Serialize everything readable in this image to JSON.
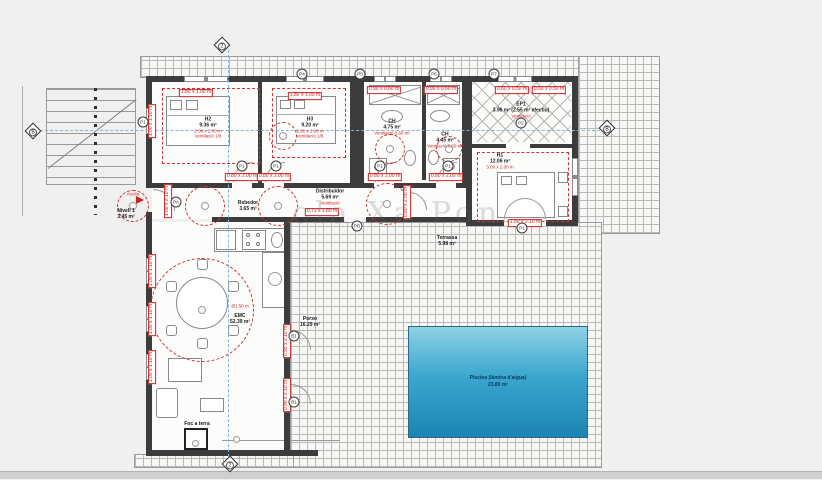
{
  "watermark": "ola Xa Pon",
  "pool": {
    "name": "Piscina (làmina d'aigua)",
    "area": "23.80 m²"
  },
  "labels": [
    {
      "id": "h2",
      "x": 208,
      "y": 128,
      "lines": [
        "H2",
        "9.36 m²"
      ],
      "red": [
        "2.00 x 2.00 m",
        "Ventilació 1/8"
      ]
    },
    {
      "id": "h3",
      "x": 310,
      "y": 128,
      "lines": [
        "H3",
        "9.20 m²"
      ],
      "red": [
        "2.00 x 2.00 m",
        "Ventilació 1/8"
      ]
    },
    {
      "id": "ch1",
      "x": 392,
      "y": 127,
      "lines": [
        "CH",
        "4.75 m²"
      ],
      "red": [
        "Ventilació 0.60 m²"
      ]
    },
    {
      "id": "ch2",
      "x": 445,
      "y": 140,
      "lines": [
        "CH",
        "4.45 m²"
      ],
      "red": [
        "Ventilació 0.60 m²"
      ]
    },
    {
      "id": "ep1",
      "x": 521,
      "y": 110,
      "lines": [
        "EP1",
        "3.96 m² (2.55 m² efectiu)"
      ],
      "red": [
        "Ventilació"
      ]
    },
    {
      "id": "h1",
      "x": 500,
      "y": 161,
      "lines": [
        "H1",
        "12.06 m²"
      ],
      "red": [
        "3.00 x 2.00 m"
      ]
    },
    {
      "id": "distribuidor",
      "x": 330,
      "y": 197,
      "lines": [
        "Distribuïdor",
        "5.69 m²"
      ],
      "red": [
        "Ventilació"
      ]
    },
    {
      "id": "rebedor",
      "x": 248,
      "y": 206,
      "lines": [
        "Rebedor",
        "3.65 m²"
      ],
      "red": []
    },
    {
      "id": "terrassa",
      "x": 447,
      "y": 241,
      "lines": [
        "Terrassa",
        "5.98 m²"
      ],
      "red": []
    },
    {
      "id": "emc-circle",
      "x": 240,
      "y": 306,
      "lines": [],
      "red": [
        "Ø1.50 m"
      ]
    },
    {
      "id": "emc",
      "x": 240,
      "y": 319,
      "lines": [
        "EMC",
        "52.39 m²"
      ],
      "red": []
    },
    {
      "id": "porxo",
      "x": 310,
      "y": 322,
      "lines": [
        "Porxo",
        "16.29 m²"
      ],
      "red": []
    },
    {
      "id": "nivell",
      "x": 126,
      "y": 214,
      "lines": [
        "Nivell 1",
        "3.45 m²"
      ],
      "red": []
    },
    {
      "id": "acces",
      "x": 133,
      "y": 194,
      "lines": [],
      "red": [
        "Accés"
      ]
    },
    {
      "id": "foc-a-terra",
      "x": 197,
      "y": 424,
      "lines": [
        "Foc a terra"
      ],
      "red": []
    }
  ],
  "dims": [
    {
      "t": "1.80 x 1.00 m",
      "x": 196,
      "y": 93,
      "v": 0
    },
    {
      "t": "1.00 x 1.10 m",
      "x": 152,
      "y": 121,
      "v": 1
    },
    {
      "t": "1.80 x 1.00 m",
      "x": 305,
      "y": 96,
      "v": 0
    },
    {
      "t": "0.90 x 0.60 m",
      "x": 384,
      "y": 90,
      "v": 0
    },
    {
      "t": "0.90 x 0.60 m",
      "x": 441,
      "y": 90,
      "v": 0
    },
    {
      "t": "0.60 x 0.50 m",
      "x": 512,
      "y": 90,
      "v": 0
    },
    {
      "t": "0.60 x 0.50 m",
      "x": 549,
      "y": 90,
      "v": 0
    },
    {
      "t": "0.80 x 2.00 m",
      "x": 242,
      "y": 177,
      "v": 0
    },
    {
      "t": "0.80 x 2.00 m",
      "x": 274,
      "y": 177,
      "v": 0
    },
    {
      "t": "0.80 x 2.00 m",
      "x": 385,
      "y": 177,
      "v": 0
    },
    {
      "t": "0.80 x 2.00 m",
      "x": 446,
      "y": 177,
      "v": 0
    },
    {
      "t": "0.80 x 2.00 m",
      "x": 407,
      "y": 202,
      "v": 1
    },
    {
      "t": "1.00 x 2.10 m",
      "x": 168,
      "y": 201,
      "v": 1
    },
    {
      "t": "0.71 x 1.80 m",
      "x": 322,
      "y": 212,
      "v": 0
    },
    {
      "t": "1.00 x 1.10 m",
      "x": 152,
      "y": 271,
      "v": 1
    },
    {
      "t": "1.00 x 1.10 m",
      "x": 152,
      "y": 319,
      "v": 1
    },
    {
      "t": "1.00 x 1.10 m",
      "x": 152,
      "y": 367,
      "v": 1
    },
    {
      "t": "0.90 x 2.10 m",
      "x": 287,
      "y": 341,
      "v": 1
    },
    {
      "t": "0.90 x 2.10 m",
      "x": 287,
      "y": 395,
      "v": 1
    },
    {
      "t": "1.80 x 2.10 m",
      "x": 525,
      "y": 223,
      "v": 0
    }
  ],
  "markers": [
    {
      "t": "P4",
      "x": 302,
      "y": 74
    },
    {
      "t": "P5",
      "x": 360,
      "y": 74
    },
    {
      "t": "P6",
      "x": 434,
      "y": 74
    },
    {
      "t": "P7",
      "x": 494,
      "y": 74
    },
    {
      "t": "P1",
      "x": 143,
      "y": 122
    },
    {
      "t": "P1",
      "x": 242,
      "y": 166
    },
    {
      "t": "P1",
      "x": 276,
      "y": 166
    },
    {
      "t": "P1",
      "x": 380,
      "y": 166
    },
    {
      "t": "P1",
      "x": 448,
      "y": 166
    },
    {
      "t": "P2",
      "x": 521,
      "y": 123
    },
    {
      "t": "PA",
      "x": 176,
      "y": 202
    },
    {
      "t": "PB",
      "x": 357,
      "y": 226
    },
    {
      "t": "P1",
      "x": 522,
      "y": 228
    },
    {
      "t": "B1",
      "x": 294,
      "y": 336
    },
    {
      "t": "B1",
      "x": 294,
      "y": 402
    }
  ],
  "axes": [
    {
      "t": "2",
      "x": 222,
      "y": 45
    },
    {
      "t": "2",
      "x": 230,
      "y": 464
    },
    {
      "t": "B",
      "x": 33,
      "y": 131
    },
    {
      "t": "B",
      "x": 607,
      "y": 128
    }
  ],
  "circles": [
    {
      "x": 283,
      "y": 136,
      "r": 14
    },
    {
      "x": 390,
      "y": 149,
      "r": 15
    },
    {
      "x": 449,
      "y": 149,
      "r": 13
    },
    {
      "x": 133,
      "y": 206,
      "r": 16
    },
    {
      "x": 205,
      "y": 206,
      "r": 20
    },
    {
      "x": 278,
      "y": 206,
      "r": 20
    },
    {
      "x": 387,
      "y": 204,
      "r": 21
    },
    {
      "x": 202,
      "y": 310,
      "r": 52
    }
  ],
  "redrects": [
    {
      "x": 162,
      "y": 88,
      "w": 98,
      "h": 76
    },
    {
      "x": 272,
      "y": 88,
      "w": 74,
      "h": 70
    },
    {
      "x": 477,
      "y": 152,
      "w": 92,
      "h": 70
    }
  ]
}
